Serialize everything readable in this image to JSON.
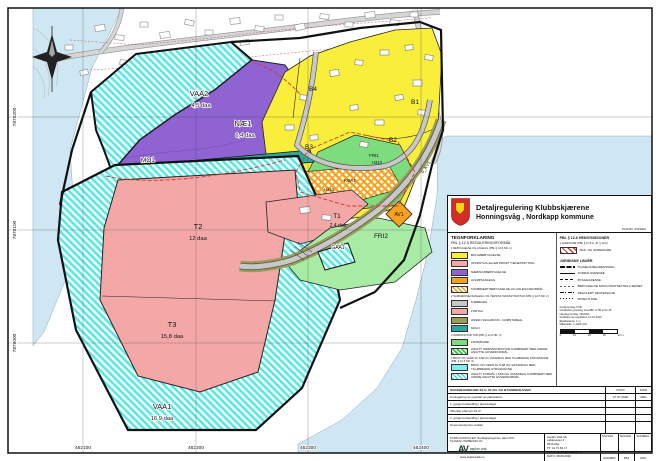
{
  "sheet": {
    "planid": "PLANID: 2019002",
    "title1": "Detaljregulering Klubbskjærene",
    "title2": "Honningsvåg , Nordkapp kommune"
  },
  "map_labels": {
    "vaa2": "VAA2",
    "vaa2_area": "4,5 daa",
    "nae1": "NÆ1",
    "nae1_area": "6,4 daa",
    "mo1": "MO1",
    "b1": "B1",
    "b2": "B2",
    "b3": "B3",
    "b4": "B4",
    "fri1": "FRI1",
    "fri1_zone": "H310",
    "kba1": "KBA1",
    "kba1_zone": "H310",
    "av1": "AV1",
    "fri2": "FRI2",
    "t1": "T1",
    "t1_area": "2,4 daa",
    "gaa1": "GAA1",
    "t2": "T2",
    "t2_area": "12 daa",
    "t3": "T3",
    "t3_area": "15,8 daa",
    "vaa1": "VAA1",
    "vaa1_area": "16,9 daa",
    "kv1": "o_KV1"
  },
  "coords": {
    "x1": "462100",
    "x2": "462200",
    "x3": "462300",
    "x4": "462400",
    "y1": "7878200",
    "y2": "7878100",
    "y3": "7878000"
  },
  "legend": {
    "heading": "TEGNFORKLARING",
    "sub1": "PBL § 12-5 REGULERINGSFORMÅL",
    "g1": {
      "title": "1 BEBYGGELSE OG ANLEGG (PBL § 12-5 NR. 1)",
      "i1": "BOLIGBEBYGGELSE",
      "i2": "OFFENTLIG ELLER PRIVAT TJENESTEYTING",
      "i3": "NÆRINGSBEBYGGELSE",
      "i4": "AVLØPSANLEGG",
      "i5": "KOMBINERT BEBYGGELSE OG ANLEGGSFORMÅL"
    },
    "g2": {
      "title": "2 SAMFERDSELSANLEGG OG TEKNISK INFRASTRUKTUR (PBL § 12-5 NR. 2)",
      "i1": "KJØREVEG",
      "i2": "FORTAU",
      "i3": "ANNEN VEGGRUNN - GRØNTAREAL",
      "i4": "MOLO"
    },
    "g3": {
      "title": "3 GRØNNSTRUKTUR (PBL § 12-5 NR. 3)",
      "i1": "FRIOMRÅDE",
      "i2": "ANGITT GRØNNSTRUKTUR KOMBINERT MED ANDRE ANGITTE HOVEDFORMÅL"
    },
    "g5": {
      "title": "5 BRUK OG VERN AV SJØ OG VASSDRAG MED TILHØRENDE STRANDSONE (PBL § 12-5 NR. 6)",
      "i1": "BRUK OG VERN AV SJØ OG VASSDRAG MED TILHØRENDE STRANDSONE",
      "i2": "ANGITT FORMÅL I SJØ OG VASSDRAG KOMBINERT MED ANDRE ANGITTE HOVEDFORMÅL"
    },
    "hens": {
      "heading": "PBL § 12-6 HENSYNSSONER",
      "g1": "1 FARESONE (PBL § 11-8 A, JF. § 12-6)",
      "i1": "RAS- OG SKREDFARE"
    },
    "lines": {
      "heading": "JURIDISKE LINJER",
      "i1": "PLANENS BEGRENSNING",
      "i2": "FORMÅLSGRENSE",
      "i3": "BYGGEGRENSE",
      "i4": "BEBYGGELSE SOM FORUTSETTES FJERNET",
      "i5": "REGULERT SENTERLINJE",
      "i6": "FRISIKTLINJE"
    },
    "basemap": {
      "l1": "Kartgrunnlag: FKB",
      "l2": "Geodetisk grunnlag: Euref89, UTM sone 35",
      "l3": "Høydegrunnlag: NN2000",
      "l4": "Kartdata sist oppdatert: 14.10.2020",
      "l5": "Ekvidistanse: 1 m",
      "l6": "Målestokk: 1:1000 (A1)",
      "s0": "0",
      "s1": "10",
      "s2": "20",
      "s3": "30",
      "s4": "40 m"
    }
  },
  "process": {
    "heading": "SAKSBEHANDLING IFLG. PLAN- OG BYGNINGSLOVEN",
    "col_date": "DATO",
    "col_sign": "SIGN",
    "r1": {
      "d": "Kunngjøring av oppstart av planarbeid",
      "date": "07.07.2020",
      "sign": "ABG"
    },
    "r2": {
      "d": "1. gangs behandling i planutvalget",
      "date": "",
      "sign": ""
    },
    "r3": {
      "d": "Offentlig ettersyn fra          til",
      "date": "",
      "sign": ""
    },
    "r4": {
      "d": "2. gangs behandling i planutvalget",
      "date": "",
      "sign": ""
    },
    "r5": {
      "d": "Kommunestyrets vedtak:",
      "date": "",
      "sign": ""
    }
  },
  "footer": {
    "proposer_label": "FORSLAGSSTILLER:",
    "proposer": "Nordkappregionen Havn IKS",
    "author_label": "PLANEN UTARBEIDET AV:",
    "logo_mark": "AV",
    "logo_text": "asplan viak",
    "web": "www.asplanviak.no",
    "addr1": "Asplan Viak AS",
    "addr2": "Løkkeveien 4",
    "addr3": "9510 Alta",
    "phone": "Tlf: 41 73 82 17",
    "email": "E-post: alta@asplanviak.no",
    "date": "DATO: 28.09.2020",
    "c1_label": "SAKSNR",
    "c1": "2019/862",
    "c2_label": "TEGNNR",
    "c2": "R01",
    "c3_label": "SAKSBEH",
    "c3": "ASO"
  },
  "colors": {
    "sea": "#CFE7F2",
    "residential_yellow": "#F9EE3A",
    "service_pink": "#F4A7A7",
    "industry_purple": "#8F63D2",
    "molo_teal": "#2AA79B",
    "green_area": "#7DDC7D",
    "green_area_light": "#A8EBA5",
    "orange": "#F6A21D",
    "sea_hatch_cyan": "#4ADADA",
    "road_verge_olive": "#9B9B55",
    "road_gray": "#C8C8C8",
    "hazard_red": "#D03B2F",
    "shield_red": "#D22D26",
    "shield_yellow": "#F7D417"
  }
}
